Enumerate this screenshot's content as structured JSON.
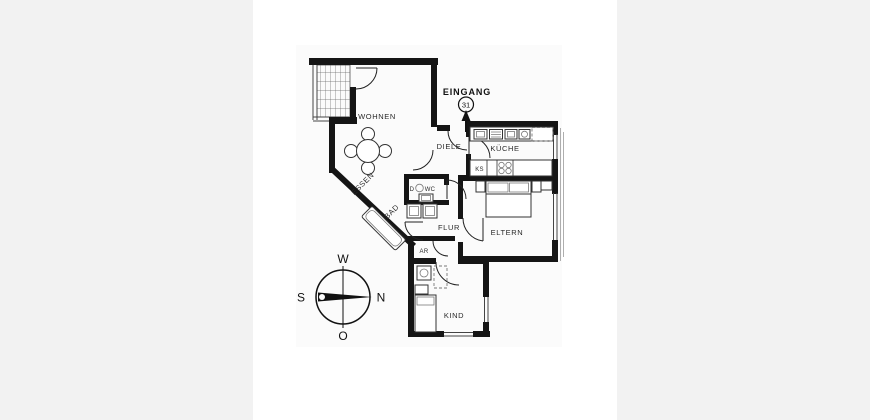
{
  "floorplan": {
    "entrance": {
      "label": "EINGANG",
      "number": "31"
    },
    "rooms": {
      "wohnen": "WOHNEN",
      "essen": "ESSEN",
      "diele": "DIELE",
      "kueche": "KÜCHE",
      "bad": "BAD",
      "wc_prefix": "D",
      "wc": "WC",
      "flur": "FLUR",
      "eltern": "ELTERN",
      "ar": "AR",
      "kind": "KIND",
      "ks": "KS"
    },
    "compass": {
      "top": "W",
      "right": "N",
      "left": "S",
      "bottom": "O"
    },
    "colors": {
      "wall": "#151515",
      "page_background": "#f2f2f2",
      "panel": "#ffffff",
      "plan_background": "#fbfbfb",
      "line": "#333333",
      "label": "#222222"
    }
  }
}
